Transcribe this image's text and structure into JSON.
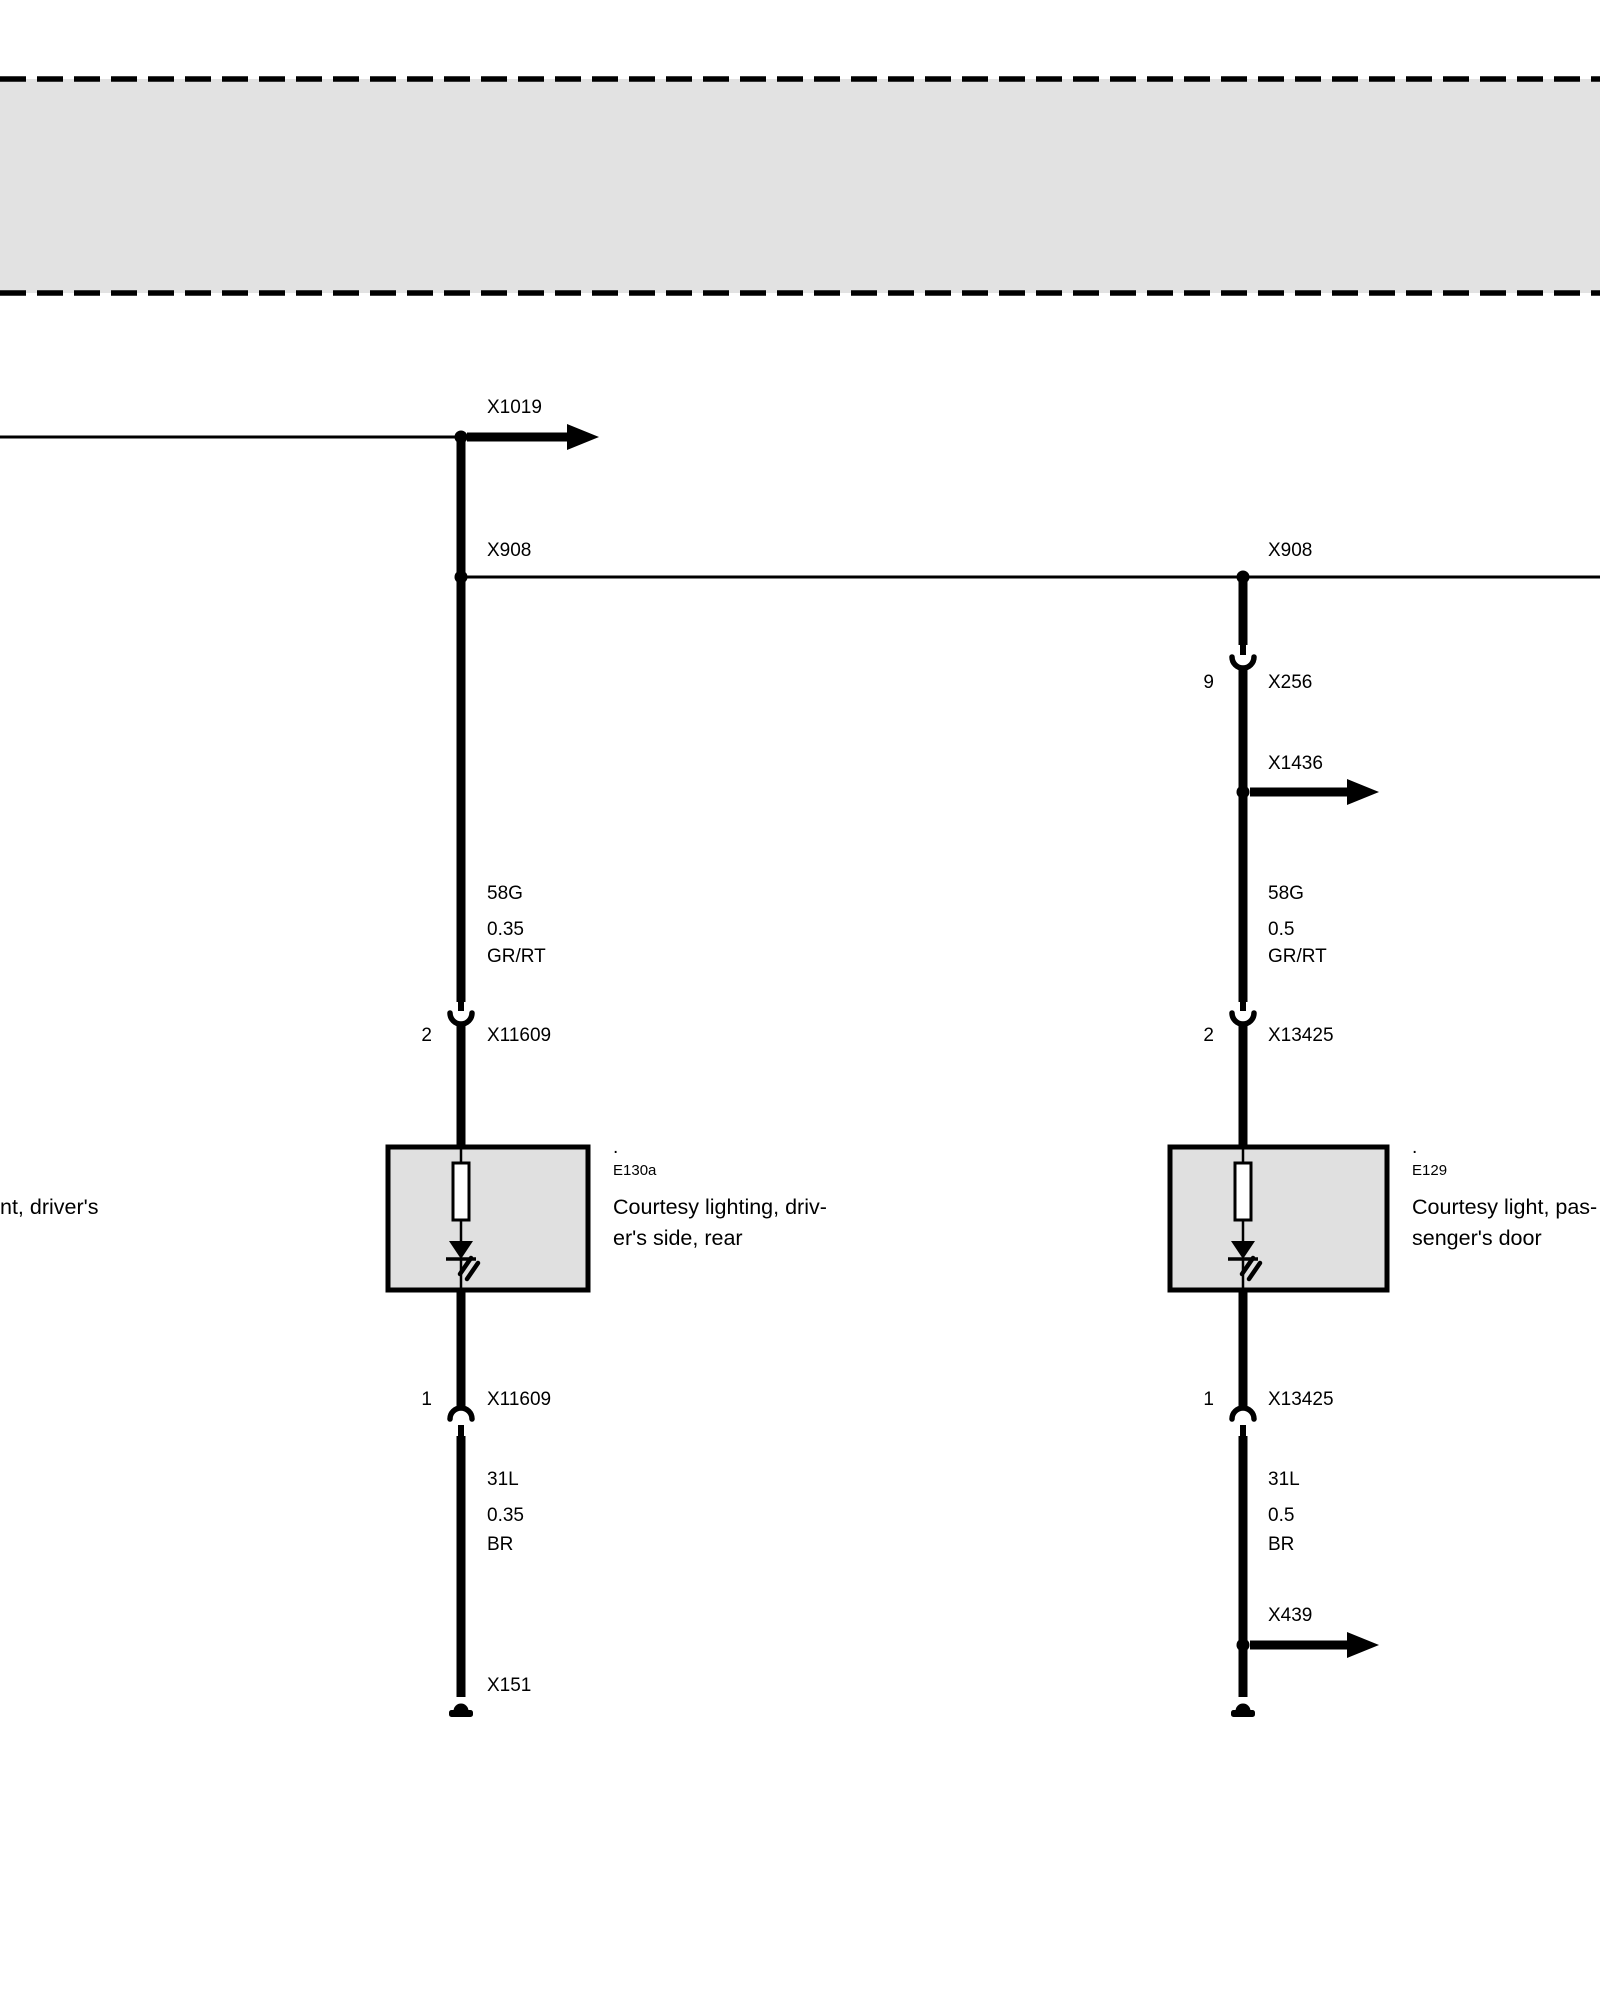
{
  "diagram": {
    "cutoff_left_text": "nt, driver's",
    "top_band": {
      "note": "empty legend band"
    },
    "left_branch": {
      "x1019_label": "X1019",
      "x908_label": "X908",
      "wire_upper": {
        "circuit": "58G",
        "gauge": "0.35",
        "color_code": "GR/RT"
      },
      "connector_top": {
        "pin": "2",
        "name": "X11609"
      },
      "component": {
        "dot": ".",
        "id": "E130a",
        "desc_line1": "Courtesy lighting, driv-",
        "desc_line2": "er's side, rear"
      },
      "connector_bottom": {
        "pin": "1",
        "name": "X11609"
      },
      "wire_lower": {
        "circuit": "31L",
        "gauge": "0.35",
        "color_code": "BR"
      },
      "ground_label": "X151"
    },
    "right_branch": {
      "x908_label": "X908",
      "connector_9": {
        "pin": "9",
        "name": "X256"
      },
      "x1436_label": "X1436",
      "wire_upper": {
        "circuit": "58G",
        "gauge": "0.5",
        "color_code": "GR/RT"
      },
      "connector_top": {
        "pin": "2",
        "name": "X13425"
      },
      "component": {
        "dot": ".",
        "id": "E129",
        "desc_line1": "Courtesy light, pas-",
        "desc_line2": "senger's door"
      },
      "connector_bottom": {
        "pin": "1",
        "name": "X13425"
      },
      "wire_lower": {
        "circuit": "31L",
        "gauge": "0.5",
        "color_code": "BR"
      },
      "x439_label": "X439"
    },
    "colors": {
      "band_fill": "#e2e2e2",
      "box_fill": "#e0e0e0",
      "line": "#000000"
    }
  }
}
